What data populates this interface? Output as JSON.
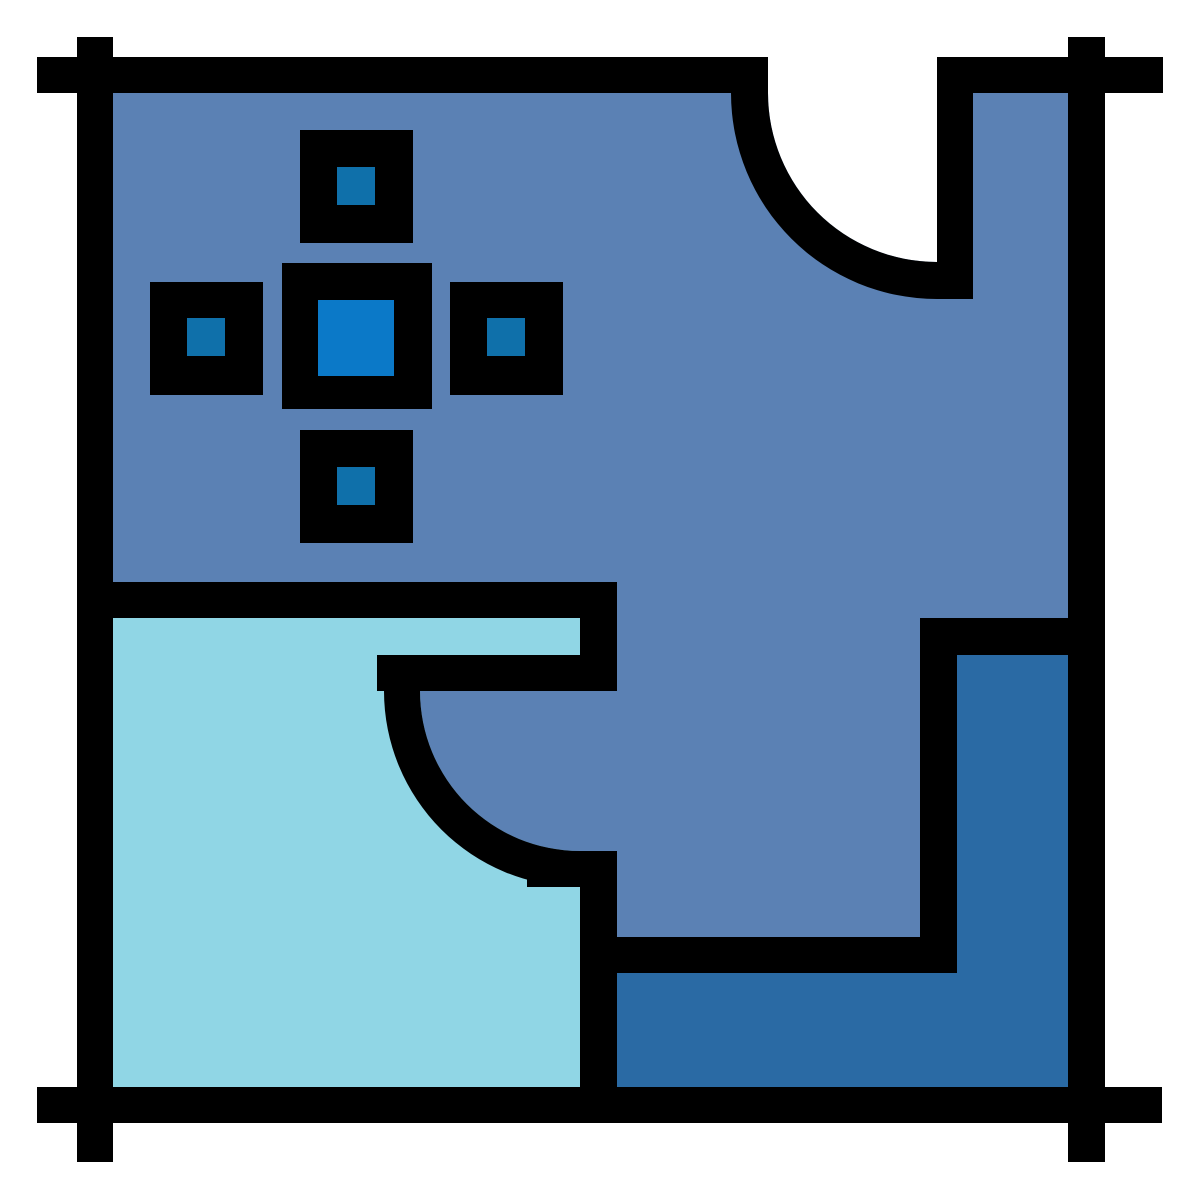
{
  "icon": {
    "label": "floor-plan-blueprint-icon"
  },
  "colors": {
    "background": "#ffffff",
    "wall": "#000000",
    "room_main": "#5b81b4",
    "room_lower_left": "#90d6e5",
    "room_lower_right": "#2a6aa4",
    "marker_center_dot": "#0b79c8",
    "marker_small_dot": "#0f70aa"
  }
}
